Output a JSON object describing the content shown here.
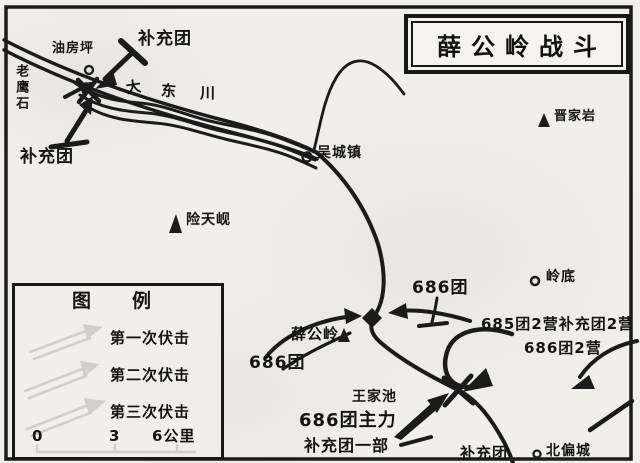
{
  "title_box": {
    "title": "薛公岭战斗"
  },
  "map_labels": {
    "youfangping": "油房坪",
    "buchongtuan_north": "补充团",
    "laoyingshi": "老鹰石",
    "buchongtuan_west": "补充团",
    "river_name_chars": [
      "大",
      "东",
      "川"
    ],
    "wuchengzhen": "吴城镇",
    "jinjiayan": "晋家岩",
    "xiantianxian": "险天岘",
    "lingdi": "岭底",
    "xuegongling": "薛公岭",
    "tuan686_west": "686团",
    "tuan686_north": "686团",
    "group_685_2ying": "685团2营补充团2营",
    "tuan686_2ying": "686团2营",
    "wangjiachi": "王家池",
    "tuan686_zhuli": "686团主力",
    "buchongtuan_yibu": "补充团一部",
    "buchongtuan_se": "补充团",
    "beipiancheng": "北偏城"
  },
  "legend": {
    "title_chars": [
      "图",
      "例"
    ],
    "items": [
      {
        "label": "第一次伏击"
      },
      {
        "label": "第二次伏击"
      },
      {
        "label": "第三次伏击"
      }
    ],
    "scale_labels": {
      "zero": "0",
      "three": "3",
      "six": "6公里"
    }
  },
  "colors": {
    "ink": "#1b1b1b",
    "paper": "#f1efec"
  }
}
